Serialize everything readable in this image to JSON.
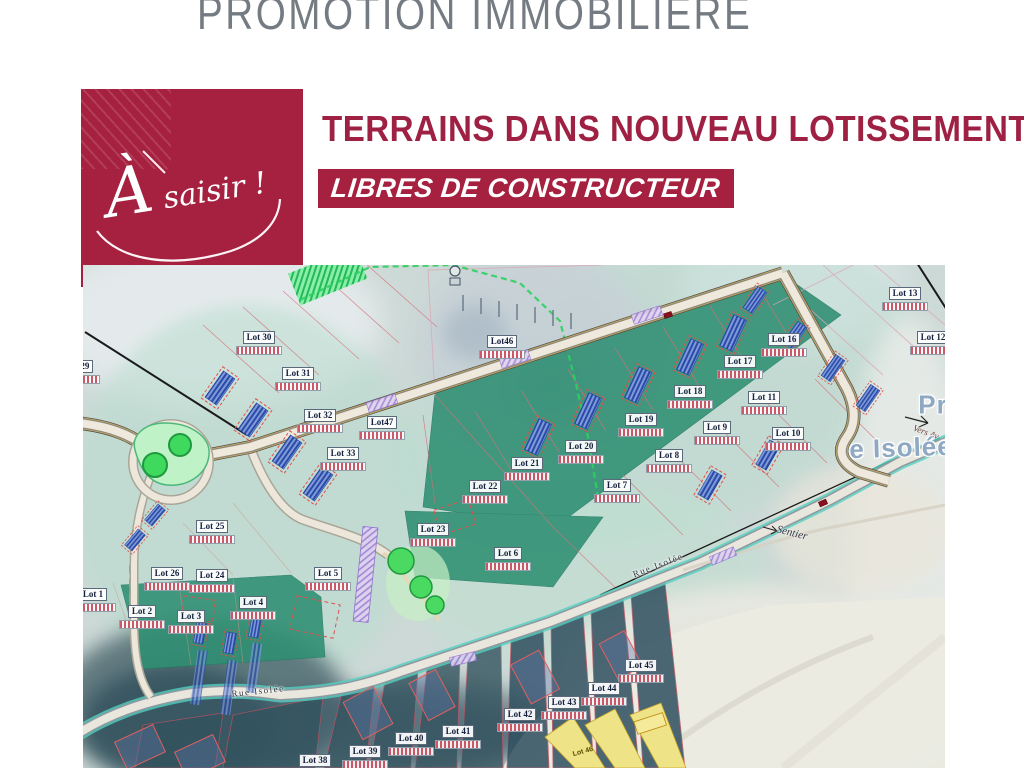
{
  "header": {
    "top_title": "PROMOTION IMMOBILIÈRE"
  },
  "badge": {
    "text": "À saisir !"
  },
  "headline": {
    "title": "TERRAINS DANS NOUVEAU LOTISSEMENT",
    "banner": "LIBRES DE CONSTRUCTEUR"
  },
  "colors": {
    "brand_red": "#A6203F",
    "headline_red": "#9E2143",
    "title_gray": "#757B82",
    "plan_teal": "#BFE0D4",
    "parcel_green": "#2E8F72",
    "road_teal_edge": "#54CFC0"
  },
  "map": {
    "lots": [
      {
        "label": "Lot 29",
        "x": -6,
        "y": 105
      },
      {
        "label": "Lot 30",
        "x": 176,
        "y": 76
      },
      {
        "label": "Lot 31",
        "x": 215,
        "y": 112
      },
      {
        "label": "Lot 32",
        "x": 237,
        "y": 154
      },
      {
        "label": "Lot 33",
        "x": 260,
        "y": 192
      },
      {
        "label": "Lot46",
        "x": 419,
        "y": 80
      },
      {
        "label": "Lot47",
        "x": 299,
        "y": 161
      },
      {
        "label": "Lot 16",
        "x": 701,
        "y": 78
      },
      {
        "label": "Lot 17",
        "x": 657,
        "y": 100
      },
      {
        "label": "Lot 18",
        "x": 607,
        "y": 130
      },
      {
        "label": "Lot 19",
        "x": 558,
        "y": 158
      },
      {
        "label": "Lot 20",
        "x": 498,
        "y": 185
      },
      {
        "label": "Lot 21",
        "x": 444,
        "y": 202
      },
      {
        "label": "Lot 22",
        "x": 402,
        "y": 225
      },
      {
        "label": "Lot 13",
        "x": 822,
        "y": 32
      },
      {
        "label": "Lot 12",
        "x": 850,
        "y": 76
      },
      {
        "label": "Lot 11",
        "x": 681,
        "y": 136
      },
      {
        "label": "Lot 9",
        "x": 634,
        "y": 166
      },
      {
        "label": "Lot 10",
        "x": 705,
        "y": 172
      },
      {
        "label": "Lot 8",
        "x": 586,
        "y": 194
      },
      {
        "label": "Lot 7",
        "x": 534,
        "y": 224
      },
      {
        "label": "Lot 6",
        "x": 425,
        "y": 292
      },
      {
        "label": "Lot 5",
        "x": 245,
        "y": 312
      },
      {
        "label": "Lot 23",
        "x": 350,
        "y": 268
      },
      {
        "label": "Lot 25",
        "x": 129,
        "y": 265
      },
      {
        "label": "Lot 24",
        "x": 129,
        "y": 314
      },
      {
        "label": "Lot 26",
        "x": 84,
        "y": 312
      },
      {
        "label": "Lot 1",
        "x": 10,
        "y": 333
      },
      {
        "label": "Lot 2",
        "x": 59,
        "y": 350
      },
      {
        "label": "Lot 3",
        "x": 108,
        "y": 355
      },
      {
        "label": "Lot 4",
        "x": 170,
        "y": 341
      },
      {
        "label": "Lot 45",
        "x": 558,
        "y": 404
      },
      {
        "label": "Lot 44",
        "x": 521,
        "y": 427
      },
      {
        "label": "Lot 43",
        "x": 481,
        "y": 441
      },
      {
        "label": "Lot 42",
        "x": 437,
        "y": 453
      },
      {
        "label": "Lot 41",
        "x": 375,
        "y": 470
      },
      {
        "label": "Lot 40",
        "x": 328,
        "y": 477
      },
      {
        "label": "Lot 39",
        "x": 282,
        "y": 490
      },
      {
        "label": "Lot 38",
        "x": 232,
        "y": 499
      }
    ],
    "street_labels": [
      {
        "text": "Rue Isolée",
        "x": 175,
        "y": 426,
        "rot": -6,
        "cls": "street-small"
      },
      {
        "text": "Rue Isolée",
        "x": 575,
        "y": 300,
        "rot": -21,
        "cls": "street-small"
      },
      {
        "text": "Sentier",
        "x": 709,
        "y": 268,
        "rot": 14,
        "cls": "street-italic"
      },
      {
        "text": "Vers Av",
        "x": 843,
        "y": 167,
        "rot": 20,
        "cls": "vers"
      },
      {
        "text": "Pr",
        "x": 850,
        "y": 140,
        "rot": 0,
        "cls": "street-big"
      },
      {
        "text": "e Isolée",
        "x": 818,
        "y": 183,
        "rot": -2,
        "cls": "street-big"
      },
      {
        "text": "Lot 46",
        "x": 500,
        "y": 487,
        "rot": -15,
        "cls": "yellow-note"
      }
    ]
  }
}
